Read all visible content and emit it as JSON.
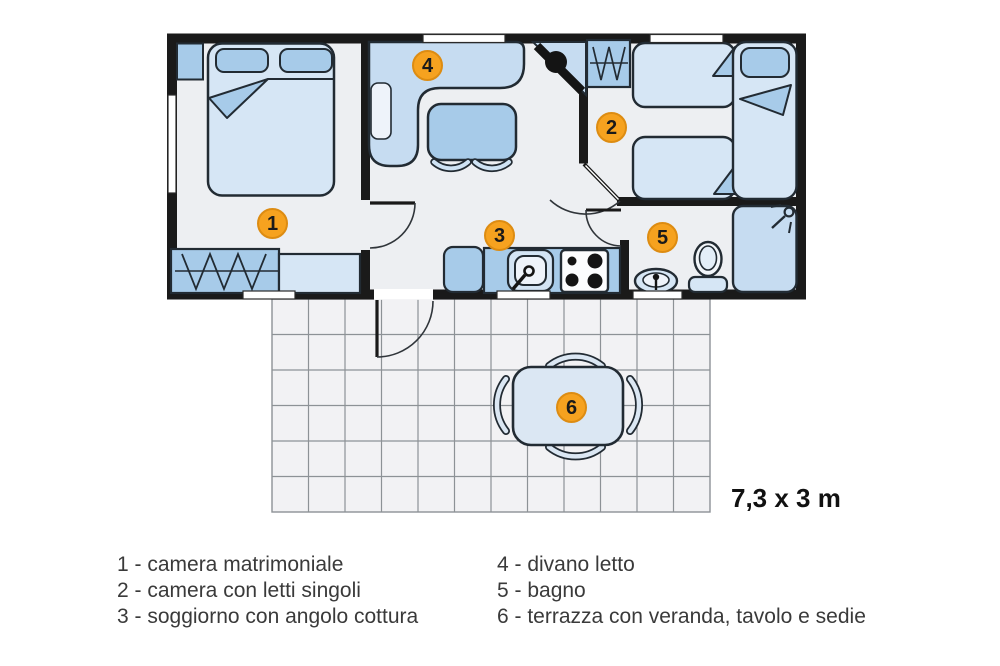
{
  "plan": {
    "dimensions_label": "7,3 x 3 m",
    "rooms": [
      {
        "number": "1",
        "name": "camera matrimoniale"
      },
      {
        "number": "2",
        "name": "camera con letti singoli"
      },
      {
        "number": "3",
        "name": "soggiorno con angolo cottura"
      },
      {
        "number": "4",
        "name": "divano letto"
      },
      {
        "number": "5",
        "name": "bagno"
      },
      {
        "number": "6",
        "name": "terrazza con veranda, tavolo e sedie"
      }
    ]
  },
  "legend": {
    "items": [
      {
        "text": "1 - camera matrimoniale"
      },
      {
        "text": "2 - camera con letti singoli"
      },
      {
        "text": "3 - soggiorno con angolo cottura"
      },
      {
        "text": "4 - divano letto"
      },
      {
        "text": "5 - bagno"
      },
      {
        "text": "6 - terrazza con veranda, tavolo e sedie"
      }
    ]
  },
  "colors": {
    "badge_fill": "#f6a21f",
    "badge_border": "#dd8c12",
    "wall": "#1a1a1a",
    "furniture_light": "#d6e6f5",
    "furniture_mid": "#a7cbe9",
    "sofa_blue": "#c6dcf1",
    "floor": "#edeff2",
    "terrace_floor": "#f2f2f4",
    "terrace_grid": "#8d9296"
  }
}
